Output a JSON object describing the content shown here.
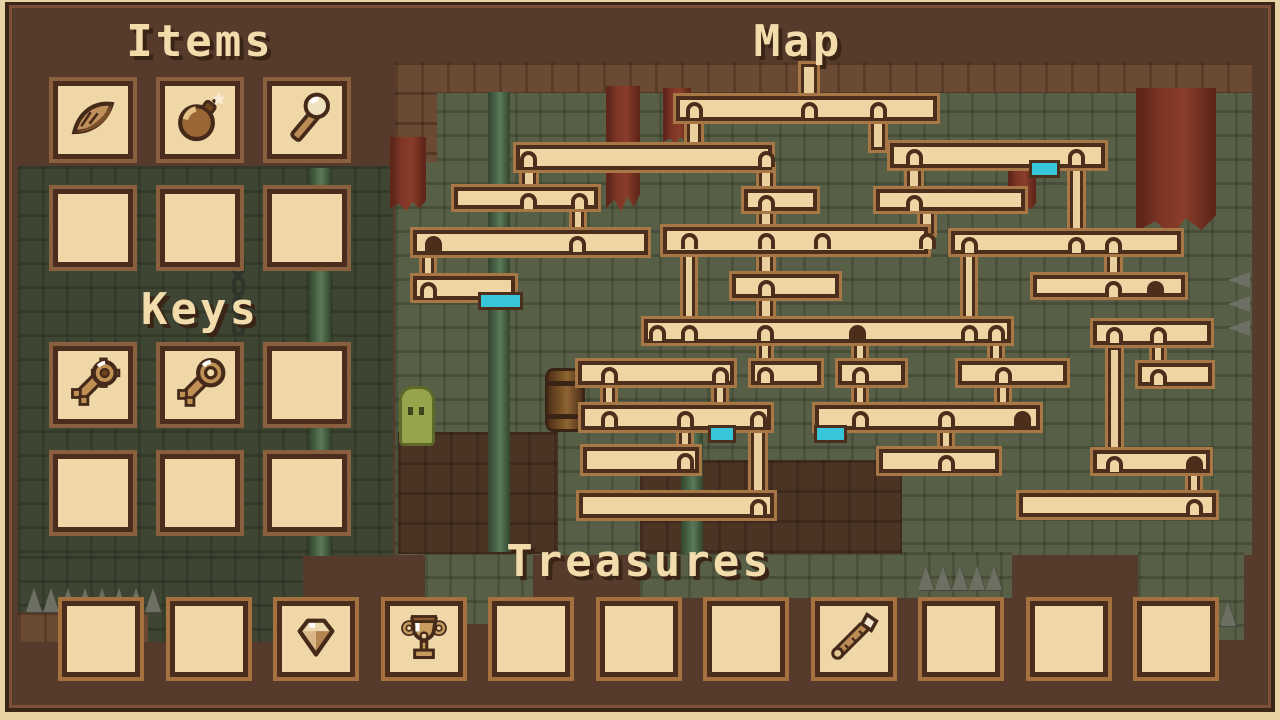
{
  "screen": {
    "name": "dungeon-inventory-map-screen"
  },
  "colors": {
    "panel_brown": "#563b2d",
    "slot_cream": "#f0d7a8",
    "rim_gold": "#a5713f",
    "outline_dark": "#4b2d1e",
    "brick_green": "#575f46",
    "brick_green_dark": "#3e4533",
    "brick_brown": "#6b4a33",
    "marker_cyan": "#38c7da",
    "banner_red": "#7d3525",
    "title_cream": "#f3dcab",
    "title_shadow": "#3a2415"
  },
  "items": {
    "title": "Items",
    "slots": [
      "feather",
      "bomb",
      "torch",
      "",
      "",
      ""
    ]
  },
  "keys": {
    "title": "Keys",
    "slots": [
      "key-gear",
      "key-round",
      "",
      "",
      "",
      ""
    ]
  },
  "treasures": {
    "title": "Treasures",
    "slots": [
      "",
      "",
      "diamond",
      "goblet",
      "",
      "",
      "",
      "scepter",
      "",
      "",
      ""
    ]
  },
  "map": {
    "title": "Map",
    "rooms": [
      [
        673,
        93,
        267,
        31
      ],
      [
        513,
        142,
        262,
        31
      ],
      [
        887,
        140,
        221,
        31
      ],
      [
        451,
        184,
        150,
        28
      ],
      [
        741,
        186,
        79,
        28
      ],
      [
        873,
        186,
        155,
        28
      ],
      [
        410,
        227,
        241,
        31
      ],
      [
        660,
        224,
        271,
        33
      ],
      [
        948,
        228,
        236,
        29
      ],
      [
        410,
        273,
        108,
        30
      ],
      [
        729,
        271,
        113,
        30
      ],
      [
        1030,
        272,
        158,
        28
      ],
      [
        641,
        316,
        373,
        30
      ],
      [
        1090,
        318,
        124,
        30
      ],
      [
        575,
        358,
        162,
        30
      ],
      [
        748,
        358,
        76,
        30
      ],
      [
        835,
        358,
        73,
        30
      ],
      [
        955,
        358,
        115,
        30
      ],
      [
        1135,
        360,
        80,
        29
      ],
      [
        578,
        402,
        196,
        31
      ],
      [
        812,
        402,
        231,
        31
      ],
      [
        580,
        444,
        122,
        32
      ],
      [
        876,
        446,
        126,
        30
      ],
      [
        1090,
        447,
        123,
        29
      ],
      [
        576,
        490,
        201,
        31
      ],
      [
        1016,
        490,
        203,
        30
      ]
    ],
    "corridors": [
      [
        799,
        64,
        20,
        32
      ],
      [
        685,
        114,
        18,
        32
      ],
      [
        869,
        114,
        18,
        30
      ],
      [
        520,
        165,
        18,
        23
      ],
      [
        757,
        165,
        18,
        25
      ],
      [
        905,
        163,
        18,
        27
      ],
      [
        1068,
        163,
        17,
        69
      ],
      [
        570,
        205,
        16,
        26
      ],
      [
        757,
        206,
        18,
        22
      ],
      [
        918,
        206,
        18,
        22
      ],
      [
        420,
        250,
        16,
        27
      ],
      [
        757,
        250,
        18,
        25
      ],
      [
        1105,
        251,
        17,
        25
      ],
      [
        681,
        252,
        16,
        68
      ],
      [
        961,
        252,
        16,
        68
      ],
      [
        757,
        296,
        18,
        24
      ],
      [
        757,
        341,
        16,
        21
      ],
      [
        852,
        341,
        16,
        21
      ],
      [
        988,
        341,
        16,
        21
      ],
      [
        1150,
        344,
        16,
        18
      ],
      [
        1106,
        347,
        17,
        103
      ],
      [
        601,
        384,
        16,
        22
      ],
      [
        712,
        384,
        16,
        22
      ],
      [
        852,
        384,
        16,
        22
      ],
      [
        995,
        384,
        16,
        22
      ],
      [
        677,
        430,
        16,
        18
      ],
      [
        938,
        430,
        16,
        20
      ],
      [
        749,
        430,
        18,
        63
      ],
      [
        1186,
        473,
        16,
        20
      ]
    ],
    "doors": [
      [
        809,
        97
      ],
      [
        694,
        97
      ],
      [
        878,
        97
      ],
      [
        528,
        146
      ],
      [
        766,
        146
      ],
      [
        914,
        144
      ],
      [
        1076,
        144
      ],
      [
        528,
        188
      ],
      [
        579,
        188
      ],
      [
        766,
        190
      ],
      [
        914,
        190
      ],
      [
        433,
        231,
        1
      ],
      [
        577,
        231
      ],
      [
        689,
        228
      ],
      [
        766,
        228
      ],
      [
        822,
        228
      ],
      [
        927,
        228
      ],
      [
        969,
        232
      ],
      [
        1076,
        232
      ],
      [
        1113,
        232
      ],
      [
        428,
        277
      ],
      [
        766,
        275
      ],
      [
        1113,
        276
      ],
      [
        1155,
        276,
        1
      ],
      [
        657,
        320
      ],
      [
        689,
        320
      ],
      [
        765,
        320
      ],
      [
        857,
        320,
        1
      ],
      [
        969,
        320
      ],
      [
        996,
        320
      ],
      [
        1114,
        322
      ],
      [
        1158,
        322
      ],
      [
        609,
        362
      ],
      [
        720,
        362
      ],
      [
        765,
        362
      ],
      [
        860,
        362
      ],
      [
        1003,
        362
      ],
      [
        1158,
        364
      ],
      [
        609,
        406
      ],
      [
        685,
        406
      ],
      [
        758,
        406
      ],
      [
        860,
        406
      ],
      [
        946,
        406
      ],
      [
        1022,
        406,
        1
      ],
      [
        685,
        448
      ],
      [
        946,
        450
      ],
      [
        1114,
        451
      ],
      [
        1194,
        451,
        1
      ],
      [
        758,
        494
      ],
      [
        1194,
        494
      ]
    ],
    "markers": [
      [
        1029,
        160,
        25
      ],
      [
        478,
        292,
        39
      ],
      [
        708,
        425,
        22
      ],
      [
        814,
        425,
        27
      ]
    ]
  }
}
